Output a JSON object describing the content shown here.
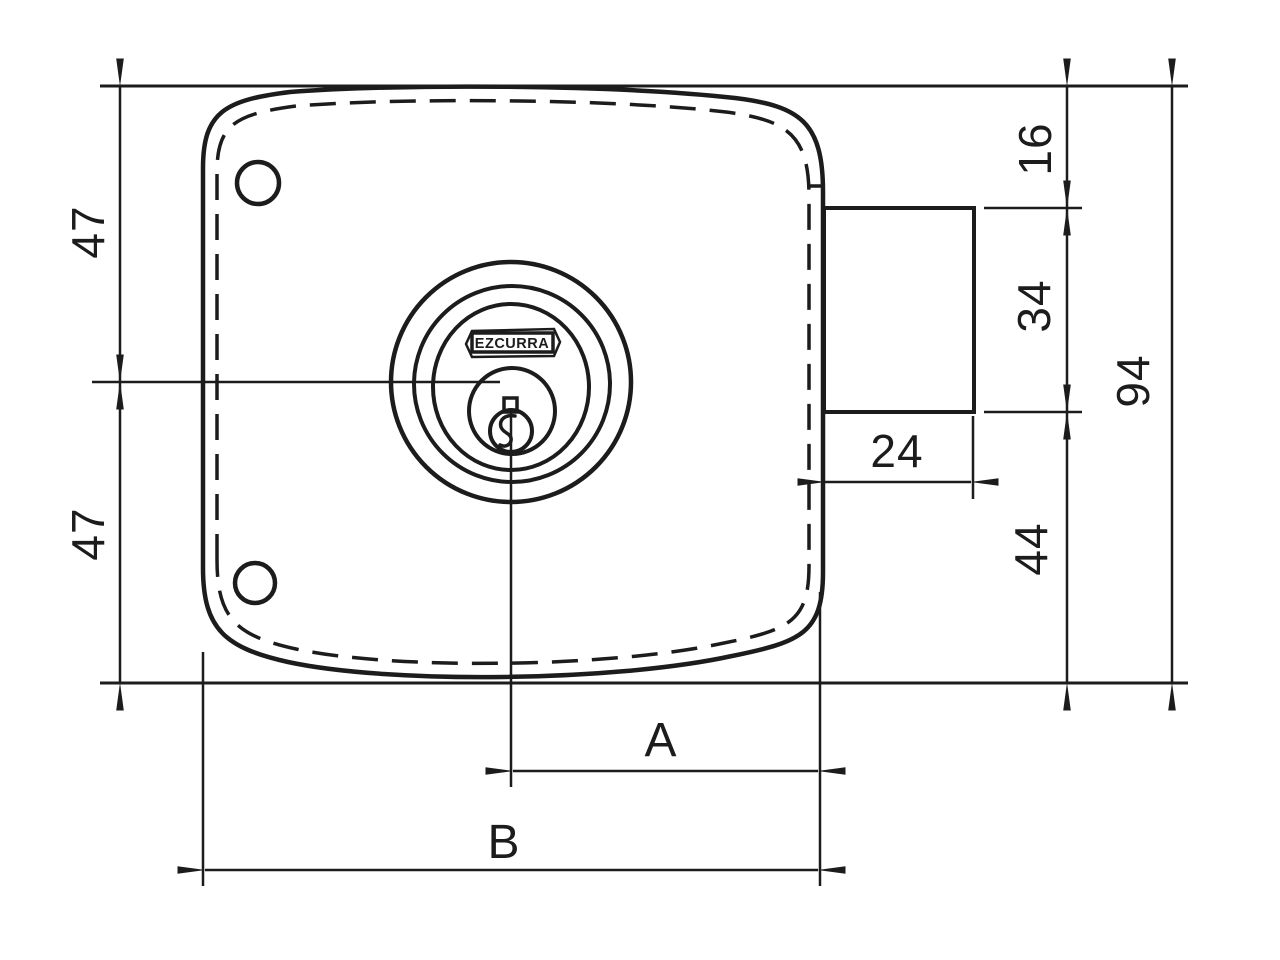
{
  "brand": "EZCURRA",
  "dimensions": {
    "left_upper": "47",
    "left_lower": "47",
    "right_top": "16",
    "right_middle": "34",
    "right_lower": "44",
    "total_height": "94",
    "bolt_width": "24",
    "label_a": "A",
    "label_b": "B"
  },
  "colors": {
    "line": "#1c1c1c",
    "background": "#ffffff"
  }
}
